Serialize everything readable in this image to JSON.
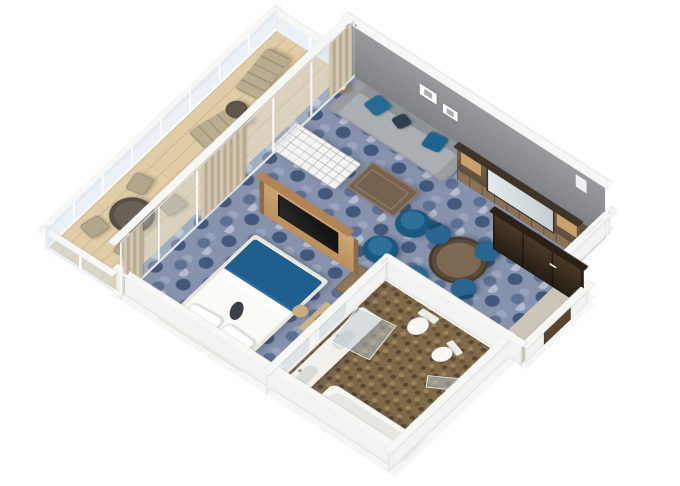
{
  "scene": {
    "type": "3d-floor-plan-render",
    "subject": "cruise ship suite isometric cutaway floor plan",
    "background": "#ffffff",
    "rooms": [
      {
        "name": "balcony",
        "floor": "light wood planks",
        "furniture": [
          "round outdoor dining table",
          "4 outdoor chairs",
          "2 sun loungers",
          "small round side table"
        ],
        "features": [
          "glass railing with white posts and top rail",
          "sliding glass door wall with beige curtains"
        ]
      },
      {
        "name": "bedroom",
        "floor": "blue patterned carpet",
        "furniture": [
          "double bed with white linens and blue foot runner",
          "2 white pillows",
          "dark clutch on bed",
          "white headboard",
          "2 white nightstands",
          "vanity desk with stool",
          "wood cabinet"
        ]
      },
      {
        "name": "living-room",
        "floor": "blue patterned carpet",
        "furniture": [
          "gray sofa with teal and navy pillows",
          "2 round side tables with lamps",
          "white tufted bench",
          "walnut coffee table",
          "2 blue tub chairs",
          "round walnut dining table",
          "4 blue dining chairs",
          "wood wall unit with mirror",
          "freestanding oak TV divider with television"
        ],
        "features": [
          "gray accent wall with 2 white picture frames"
        ]
      },
      {
        "name": "bathroom",
        "floor": "brown mosaic tile",
        "furniture": [
          "double sink vanity counter",
          "2 mirror panels",
          "bathtub",
          "toilet",
          "bidet",
          "glass shower panel"
        ]
      },
      {
        "name": "entry",
        "features": [
          "dark brown wardrobe closet",
          "entry corridor with white walls",
          "entry door"
        ]
      }
    ],
    "palette": {
      "carpet_base": "#8793ad",
      "carpet_dark": "#44587e",
      "carpet_light": "#b6bcce",
      "wood_floor": "#e0cda7",
      "gray_wall": "#8b8c90",
      "accent_blue": "#2e6f9c",
      "bed_blue": "#1f5e8d",
      "oak": "#c59e6b",
      "walnut": "#6e5b4a",
      "dark_wood": "#3b2e22",
      "tan": "#b9ac8f",
      "white_wall": "#f5f5f3",
      "mosaic_brown": "#7f6a4a"
    }
  }
}
